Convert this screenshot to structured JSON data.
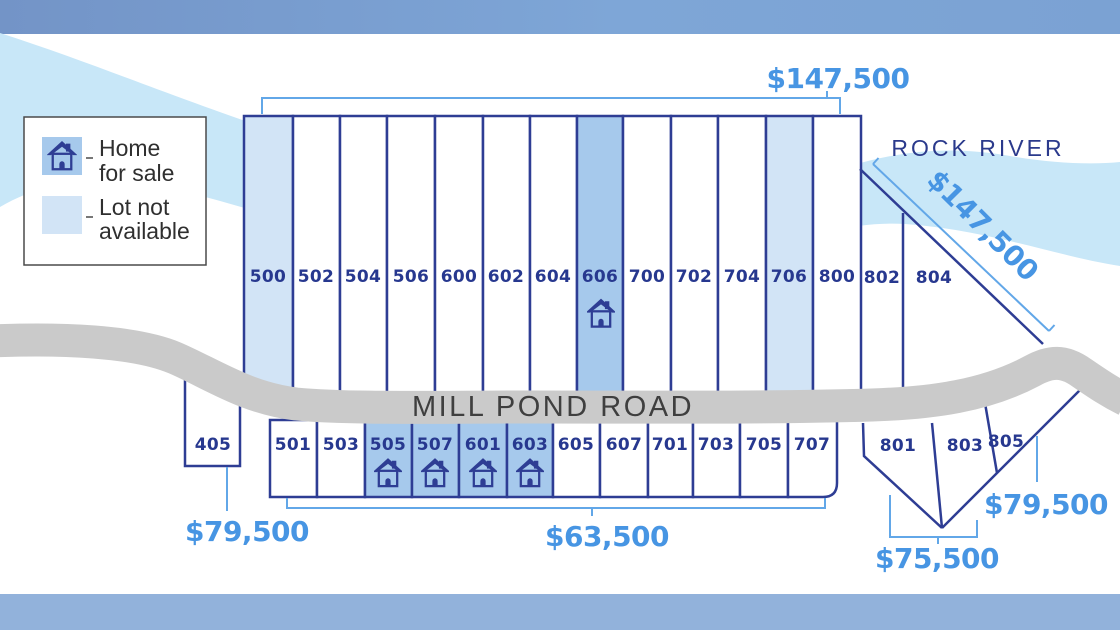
{
  "legend": {
    "home_for_sale": {
      "line1": "Home",
      "line2": "for sale"
    },
    "lot_not_available": {
      "line1": "Lot not",
      "line2": "available"
    }
  },
  "map_labels": {
    "river": "ROCK RIVER",
    "road": "MILL POND ROAD"
  },
  "prices": {
    "top_row": "$147,500",
    "riverfront_lots": "$147,500",
    "lot_405": "$79,500",
    "bottom_row": "$63,500",
    "lots_801_803": "$75,500",
    "lot_805": "$79,500"
  },
  "lots": {
    "top_row": [
      {
        "id": "500",
        "status": "lot_not_available"
      },
      {
        "id": "502",
        "status": "available"
      },
      {
        "id": "504",
        "status": "available"
      },
      {
        "id": "506",
        "status": "available"
      },
      {
        "id": "600",
        "status": "available"
      },
      {
        "id": "602",
        "status": "available"
      },
      {
        "id": "604",
        "status": "available"
      },
      {
        "id": "606",
        "status": "home_for_sale"
      },
      {
        "id": "700",
        "status": "available"
      },
      {
        "id": "702",
        "status": "available"
      },
      {
        "id": "704",
        "status": "available"
      },
      {
        "id": "706",
        "status": "lot_not_available"
      },
      {
        "id": "800",
        "status": "available"
      }
    ],
    "river_row": [
      {
        "id": "802",
        "status": "available"
      },
      {
        "id": "804",
        "status": "available"
      }
    ],
    "bottom_row": [
      {
        "id": "501",
        "status": "available"
      },
      {
        "id": "503",
        "status": "available"
      },
      {
        "id": "505",
        "status": "home_for_sale"
      },
      {
        "id": "507",
        "status": "home_for_sale"
      },
      {
        "id": "601",
        "status": "home_for_sale"
      },
      {
        "id": "603",
        "status": "home_for_sale"
      },
      {
        "id": "605",
        "status": "available"
      },
      {
        "id": "607",
        "status": "available"
      },
      {
        "id": "701",
        "status": "available"
      },
      {
        "id": "703",
        "status": "available"
      },
      {
        "id": "705",
        "status": "available"
      },
      {
        "id": "707",
        "status": "available"
      }
    ],
    "west": [
      {
        "id": "405",
        "status": "available"
      }
    ],
    "southeast": [
      {
        "id": "801",
        "status": "available"
      },
      {
        "id": "803",
        "status": "available"
      },
      {
        "id": "805",
        "status": "available"
      }
    ]
  },
  "colors": {
    "navy_border": "#2e3d94",
    "lot_number_text": "#27388f",
    "price_text": "#4795e3",
    "bracket_line": "#62a7e8",
    "river_fill": "#c8e7f8",
    "lot_not_available_fill": "#d2e4f6",
    "home_for_sale_fill": "#a6c9ec",
    "road_fill": "#cacaca",
    "road_text": "#3f3f3f",
    "top_bar": "#7b9fd1",
    "bottom_bar": "#92b2db"
  }
}
